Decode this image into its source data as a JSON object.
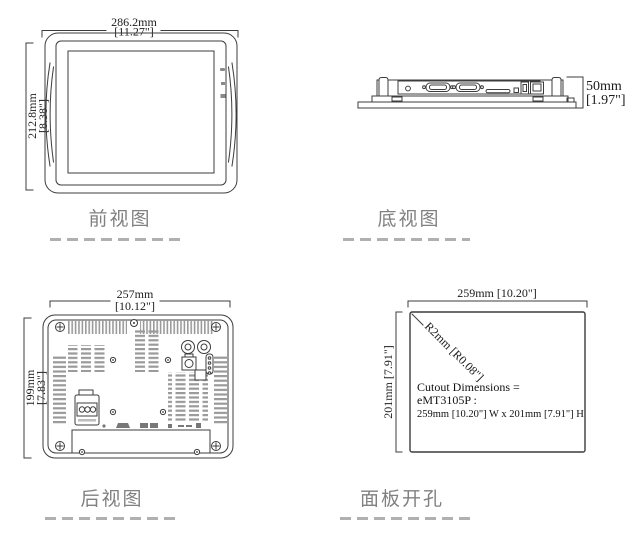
{
  "views": {
    "front": {
      "label": "前视图",
      "width_mm": "286.2mm",
      "width_in": "[11.27\"]",
      "height_mm": "212.8mm",
      "height_in": "[8.38\"]"
    },
    "bottom": {
      "label": "底视图",
      "depth_mm": "50mm",
      "depth_in": "[1.97\"]"
    },
    "rear": {
      "label": "后视图",
      "width_mm": "257mm",
      "width_in": "[10.12\"]",
      "height_mm": "199mm",
      "height_in": "[7.83\"]"
    },
    "cutout": {
      "label": "面板开孔",
      "width_dim": "259mm [10.20\"]",
      "height_dim": "201mm [7.91\"]",
      "radius_dim": "R2mm [R0.08\"]",
      "note_line1": "Cutout Dimensions =",
      "note_line2": "eMT3105P :",
      "note_line3": "259mm [10.20\"] W x 201mm [7.91\"] H"
    }
  },
  "colors": {
    "line": "#3c3c3c",
    "dim_text": "#1b1b1b",
    "label_text": "#818181",
    "dash": "#b0b0b0",
    "vent": "#9a9a9a"
  }
}
